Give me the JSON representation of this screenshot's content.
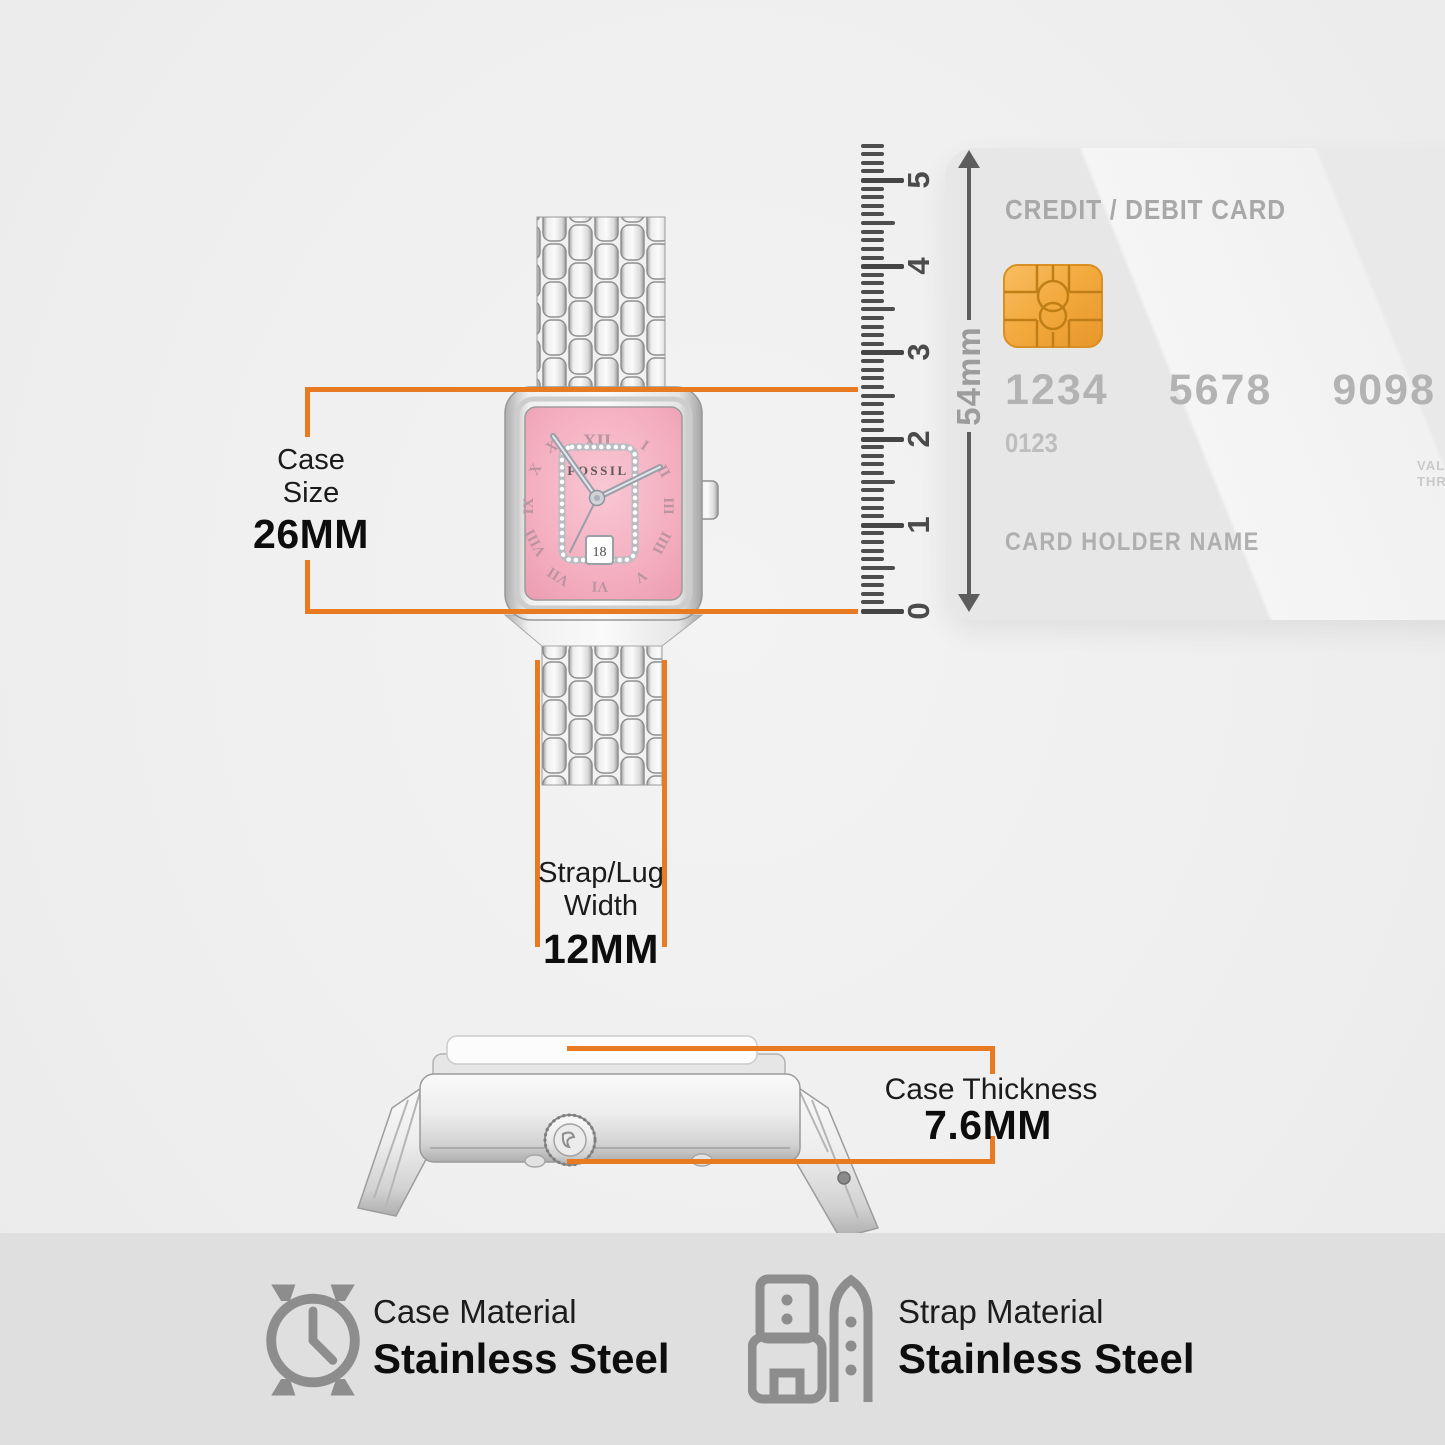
{
  "colors": {
    "accent": "#E87A22",
    "dial_pink": "#F3ABBE",
    "chip_gold": "#F2A93C",
    "icon_gray": "#8D8D8D",
    "page_bg": "#EFEFEF",
    "bottom_bg": "#DFDFDF"
  },
  "annotations": {
    "case_size": {
      "label_line1": "Case",
      "label_line2": "Size",
      "value": "26MM"
    },
    "strap_width": {
      "label_line1": "Strap/Lug",
      "label_line2": "Width",
      "value": "12MM"
    },
    "case_thickness": {
      "label": "Case Thickness",
      "value": "7.6MM"
    }
  },
  "ruler": {
    "labels": [
      "0",
      "1",
      "2",
      "3",
      "4",
      "5"
    ],
    "unit": "cm",
    "zero_y": 611,
    "px_per_unit": 86.2,
    "minor_step": 0.1,
    "minor_count": 54
  },
  "card": {
    "title": "CREDIT / DEBIT CARD",
    "number_groups": [
      "1234",
      "5678",
      "9098"
    ],
    "sub_number": "0123",
    "valid_line1": "VALID",
    "valid_line2": "THRU",
    "holder": "CARD HOLDER NAME",
    "height_label": "54mm"
  },
  "watch_front": {
    "brand": "FOSSIL",
    "date": "18",
    "dial_numerals": [
      "XII",
      "I",
      "II",
      "III",
      "IIII",
      "V",
      "VI",
      "VII",
      "VIII",
      "IX",
      "X",
      "XI"
    ]
  },
  "materials": [
    {
      "label": "Case Material",
      "value": "Stainless Steel",
      "icon": "watch-case-icon"
    },
    {
      "label": "Strap Material",
      "value": "Stainless Steel",
      "icon": "watch-strap-icon"
    }
  ]
}
